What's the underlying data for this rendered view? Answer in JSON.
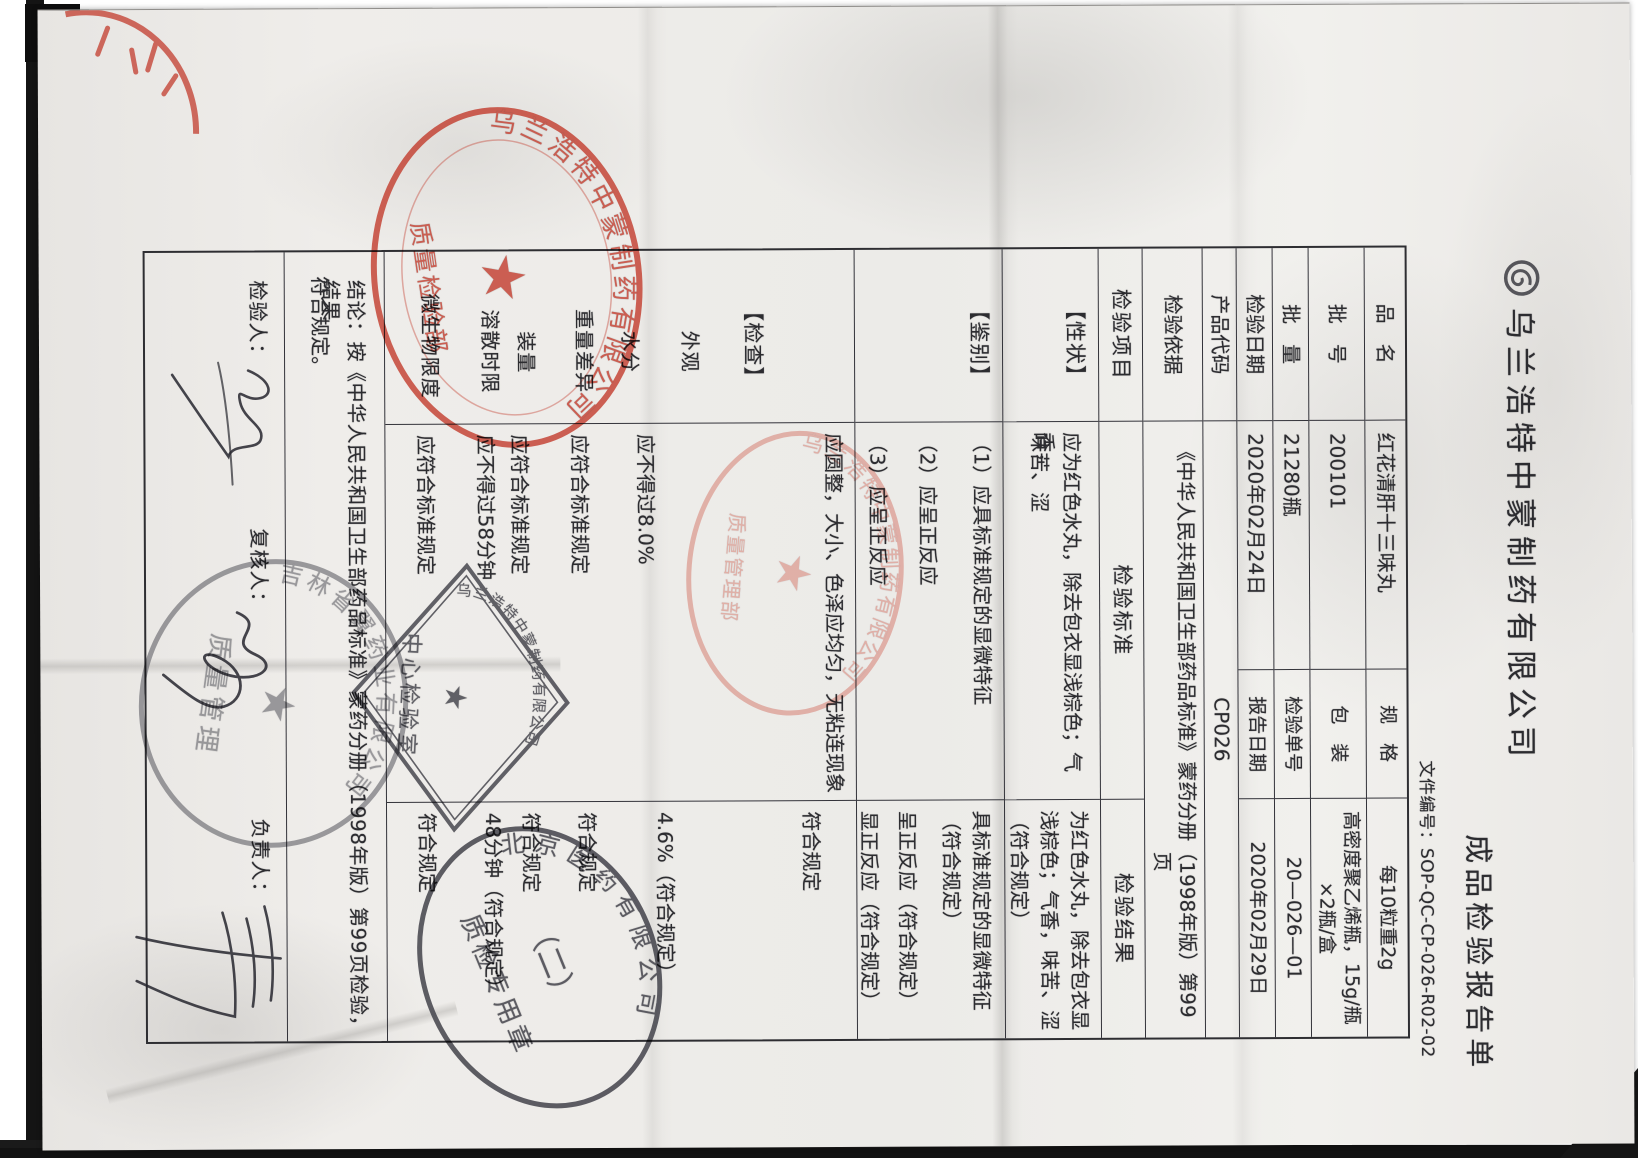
{
  "document": {
    "company": "乌兰浩特中蒙制药有限公司",
    "title": "成品检验报告单",
    "doc_number": "文件编号：SOP-QC-CP-026-R02-02",
    "info_rows": [
      {
        "label": "品　名",
        "value": "红花清肝十三味丸",
        "label2": "规　格",
        "value2": "每10粒重2g"
      },
      {
        "label": "批　号",
        "value": "200101",
        "label2": "包　装",
        "value2": "高密度聚乙烯瓶，15g/瓶×2瓶/盒"
      },
      {
        "label": "批　量",
        "value": "21280瓶",
        "label2": "检验单号",
        "value2": "20—026—01"
      },
      {
        "label": "检验日期",
        "value": "2020年02月24日",
        "label2": "报告日期",
        "value2": "2020年02月29日"
      },
      {
        "label": "产品代码",
        "value": "CP026"
      },
      {
        "label": "检验依据",
        "value_line1": "《中华人民共和国卫生部药品标准》蒙药分册（1998年版）第99",
        "value_line2": "页"
      }
    ],
    "table_header": {
      "item": "检验项目",
      "standard": "检验标准",
      "result": "检验结果"
    },
    "xingzhuang": {
      "name": "【性状】",
      "standard_lines": [
        "应为红色水丸，除去包衣显浅棕色；气香，",
        "味苦、涩"
      ],
      "result_lines": [
        "为红色水丸，除去包衣显",
        "浅棕色；气香，味苦、涩",
        "（符合规定）"
      ]
    },
    "jianbie": {
      "name": "【鉴别】",
      "standard_lines": [
        "（1）应具标准规定的显微特征",
        "（2）应呈正反应",
        "（3）应呈正反应"
      ],
      "result_lines": [
        "具标准规定的显微特征",
        "（符合规定）",
        "呈正反应（符合规定）",
        "显正反应（符合规定）"
      ]
    },
    "jiancha": {
      "name": "【检查】",
      "items": [
        "外观",
        "水分",
        "重量差异",
        "装量",
        "溶散时限",
        "微生物限度"
      ],
      "standards": [
        "应圆整，大小、色泽应均匀，无粘连现象",
        "应不得过8.0%",
        "应符合标准规定",
        "应符合标准规定",
        "应不得过58分钟",
        "应符合标准规定"
      ],
      "results": [
        "符合规定",
        "4.6%（符合规定）",
        "符合规定",
        "符合规定",
        "48分钟（符合规定）",
        "符合规定"
      ]
    },
    "conclusion_line1": "结论：按《中华人民共和国卫生部药品标准》蒙药分册（1998年版）第99页检验，结果",
    "conclusion_line2": "符合规定。",
    "signatures": [
      {
        "label": "检验人："
      },
      {
        "label": "复核人："
      },
      {
        "label": "负责人："
      }
    ],
    "stamps": {
      "red_company_seal": {
        "rim": "乌兰浩特中蒙制药有限公司",
        "banner": "质量检验部",
        "star": "★"
      },
      "pink_qa_seal": {
        "rim": "乌兰浩特中蒙制药有限公司",
        "banner": "质量管理部",
        "star": "★"
      },
      "diamond_lab_seal": {
        "line1": "乌兰浩特中蒙制药有限公司",
        "line2": "中心检验室",
        "star": "★"
      },
      "black_qc_seal": {
        "rim": "北京医药有限公司",
        "center": "（二）",
        "banner": "质检专用章"
      },
      "gray_oval_seal": {
        "rim": "吉林省翼药业有限公司",
        "banner": "质量管理",
        "star": "★"
      }
    }
  }
}
